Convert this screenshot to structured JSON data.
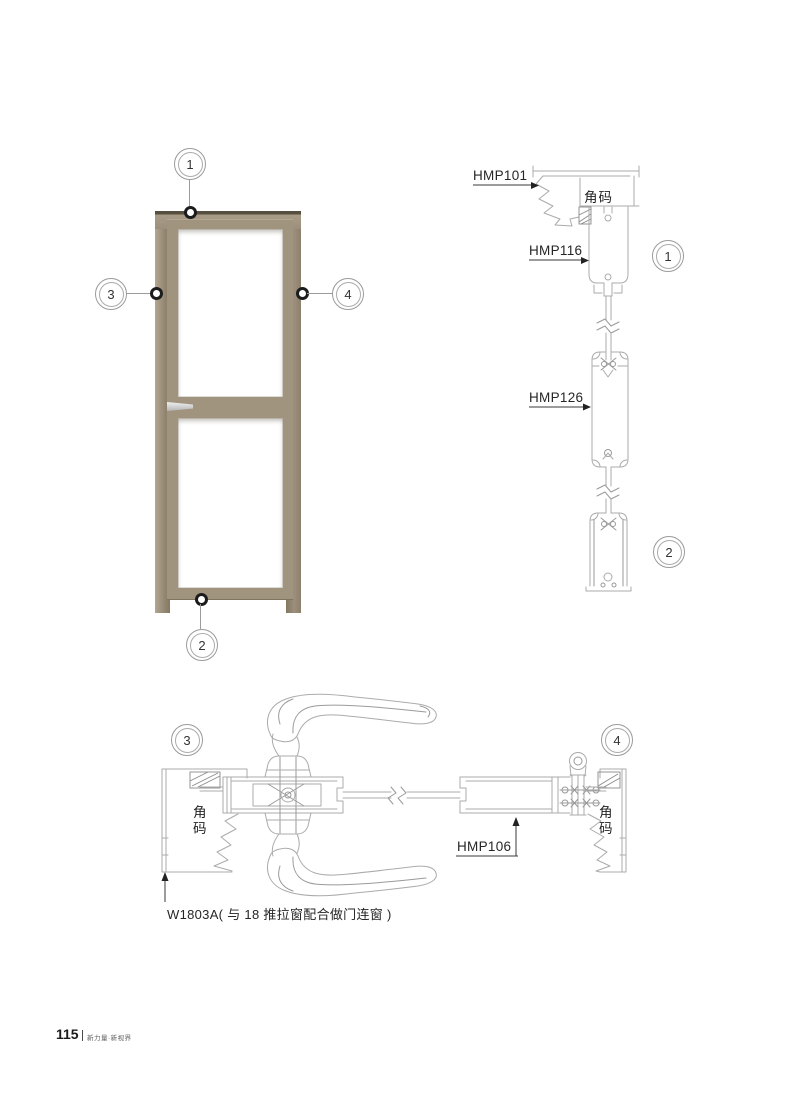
{
  "labels": {
    "hmp101": "HMP101",
    "hmp116": "HMP116",
    "hmp126": "HMP126",
    "hmp106": "HMP106",
    "w1803a": "W1803A( 与 18 推拉窗配合做门连窗 )",
    "corner_code_head": "角码",
    "corner_code_left": "角码",
    "corner_code_right": "角码"
  },
  "callouts": {
    "c1": "1",
    "c2": "2",
    "c3": "3",
    "c4": "4"
  },
  "footer": {
    "page_number": "115",
    "brand": "新力量·新视界"
  },
  "colors": {
    "line_art": "#ababab",
    "label_text": "#262626",
    "door_frame": "#9c8f7c",
    "door_leaf": "#a1947e",
    "handle_silver": "#c8c8c8",
    "leader": "#3a3a3a"
  }
}
